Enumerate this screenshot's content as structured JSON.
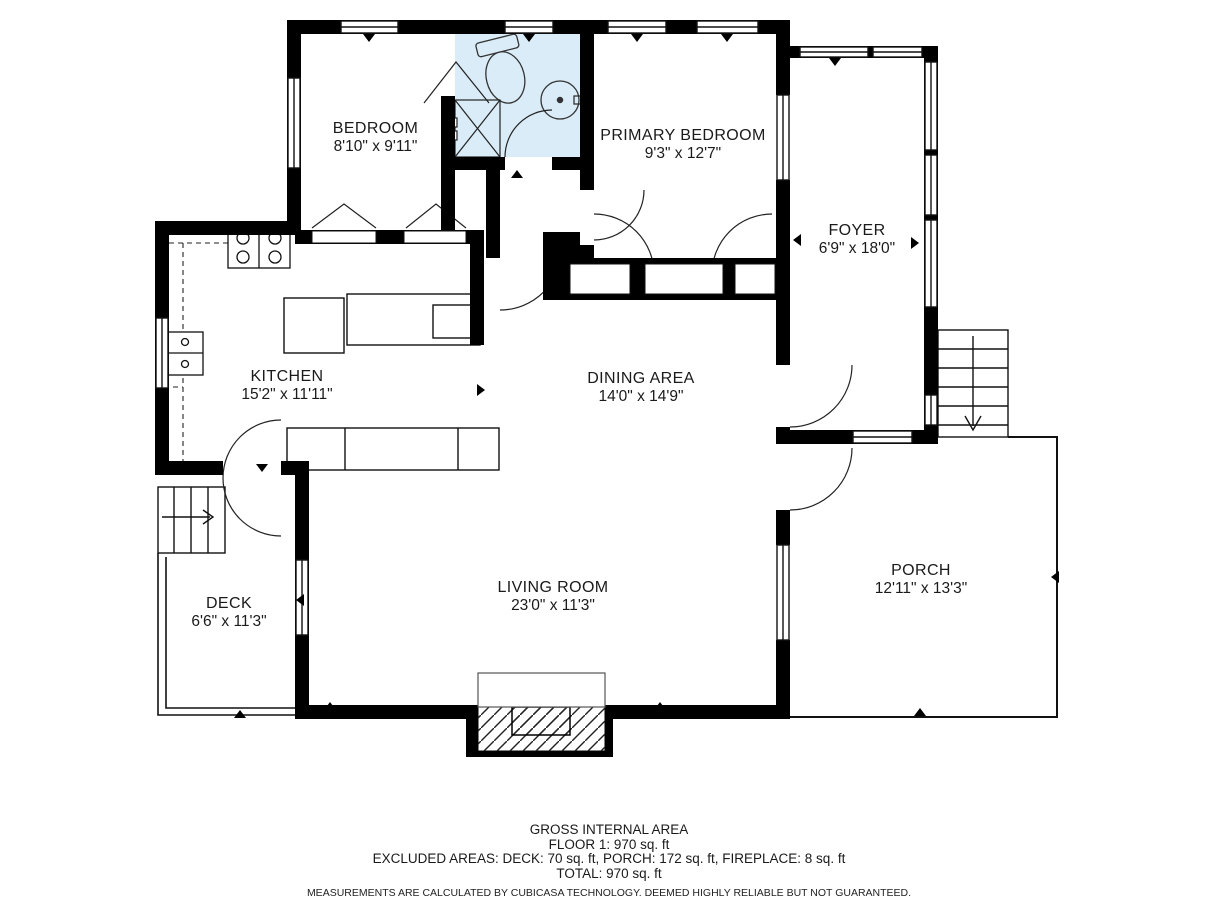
{
  "meta": {
    "plan_type": "floor-plan",
    "wall_color": "#000000",
    "bath_fill": "#d9ecf7",
    "background": "#ffffff"
  },
  "rooms": [
    {
      "id": "bedroom",
      "name": "BEDROOM",
      "dims": "8'10\" x 9'11\""
    },
    {
      "id": "bath",
      "name": "BATH",
      "dims": "8'2\" x 6'5\""
    },
    {
      "id": "primary-bedroom",
      "name": "PRIMARY BEDROOM",
      "dims": "9'3\" x 12'7\""
    },
    {
      "id": "foyer",
      "name": "FOYER",
      "dims": "6'9\" x 18'0\""
    },
    {
      "id": "kitchen",
      "name": "KITCHEN",
      "dims": "15'2\" x 11'11\""
    },
    {
      "id": "dining-area",
      "name": "DINING AREA",
      "dims": "14'0\" x 14'9\""
    },
    {
      "id": "living-room",
      "name": "LIVING ROOM",
      "dims": "23'0\" x 11'3\""
    },
    {
      "id": "deck",
      "name": "DECK",
      "dims": "6'6\" x 11'3\""
    },
    {
      "id": "porch",
      "name": "PORCH",
      "dims": "12'11\" x 13'3\""
    }
  ],
  "fixtures": [
    "toilet",
    "bathroom-sink",
    "shower",
    "stove",
    "kitchen-sink",
    "counter",
    "fireplace",
    "stairs-down-foyer",
    "stairs-deck",
    "closet-doors"
  ],
  "footer": {
    "line1": "GROSS INTERNAL AREA",
    "line2": "FLOOR 1: 970 sq. ft",
    "line3": "EXCLUDED AREAS: DECK: 70 sq. ft, PORCH: 172 sq. ft, FIREPLACE: 8 sq. ft",
    "line4": "TOTAL: 970 sq. ft",
    "disclaimer": "MEASUREMENTS ARE CALCULATED BY CUBICASA TECHNOLOGY. DEEMED HIGHLY RELIABLE BUT NOT GUARANTEED."
  }
}
